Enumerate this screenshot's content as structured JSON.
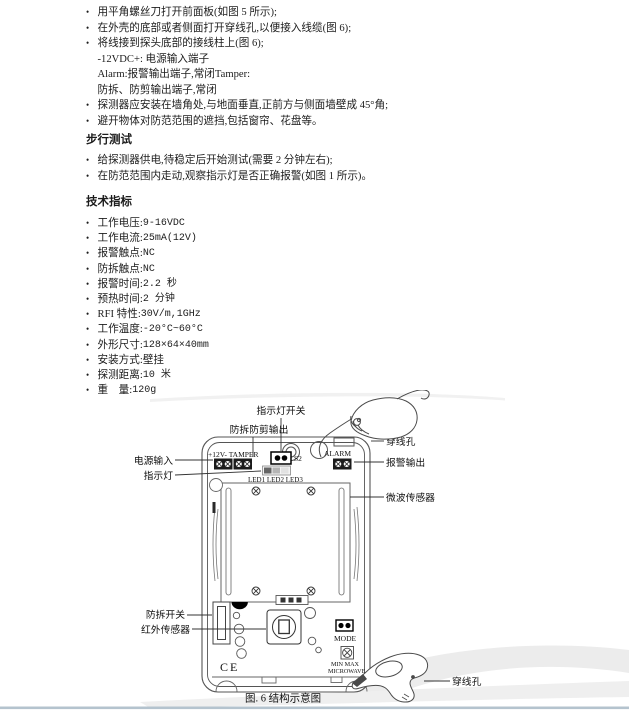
{
  "installation": {
    "items": [
      {
        "text": "用平角螺丝刀打开前面板(如图 5 所示);"
      },
      {
        "text": "在外壳的底部或者侧面打开穿线孔,以便接入线缆(图 6);"
      },
      {
        "text": "将线接到探头底部的接线柱上(图 6);"
      },
      {
        "text": "-12VDC+: 电源输入端子",
        "indent": true
      },
      {
        "text": "Alarm:报警输出端子,常闭Tamper:",
        "indent": true
      },
      {
        "text": "防拆、防剪输出端子,常闭",
        "indent": true
      },
      {
        "text": "探测器应安装在墙角处,与地面垂直,正前方与侧面墙壁成 45°角;"
      },
      {
        "text": "避开物体对防范范围的遮挡,包括窗帘、花盘等。"
      }
    ]
  },
  "walk_test": {
    "heading": "步行测试",
    "items": [
      {
        "text": "给探测器供电,待稳定后开始测试(需要 2 分钟左右);"
      },
      {
        "text": "在防范范围内走动,观察指示灯是否正确报警(如图 1 所示)。"
      }
    ]
  },
  "specs": {
    "heading": "技术指标",
    "items": [
      {
        "label": "工作电压:",
        "value": "9-16VDC"
      },
      {
        "label": "工作电流:",
        "value": "25mA(12V)"
      },
      {
        "label": "报警触点:",
        "value": "NC"
      },
      {
        "label": "防拆触点:",
        "value": "NC"
      },
      {
        "label": "报警时间:",
        "value": "2.2 秒"
      },
      {
        "label": "预热时间:",
        "value": "2 分钟"
      },
      {
        "label": "RFI 特性:",
        "value": "30V/m,1GHz"
      },
      {
        "label": "工作温度:",
        "value": "-20°C~60°C"
      },
      {
        "label": "外形尺寸:",
        "value": "128×64×40mm"
      },
      {
        "label": "安装方式:",
        "value": "壁挂"
      },
      {
        "label": "探测距离:",
        "value": "10 米"
      },
      {
        "label": "重　量:",
        "value": "120g"
      }
    ]
  },
  "diagram": {
    "caption": "图. 6 结构示意图",
    "labels": {
      "led_switch": "指示灯开关",
      "tamper_output": "防拆防剪输出",
      "wire_hole_top": "穿线孔",
      "power_input": "电源输入",
      "indicator_light": "指示灯",
      "alarm_output": "报警输出",
      "microwave_sensor": "微波传感器",
      "tamper_switch": "防拆开关",
      "ir_sensor": "红外传感器",
      "wire_hole_bottom": "穿线孔"
    },
    "board": {
      "power_terminal": "+12V- TAMPER",
      "s2": "S2",
      "alarm": "ALARM",
      "leds": "LED1 LED2 LED3",
      "mode": "MODE",
      "mw_range": "MIN MAX",
      "mw_name": "MICROWAVE",
      "ce_mark": "CE"
    }
  }
}
